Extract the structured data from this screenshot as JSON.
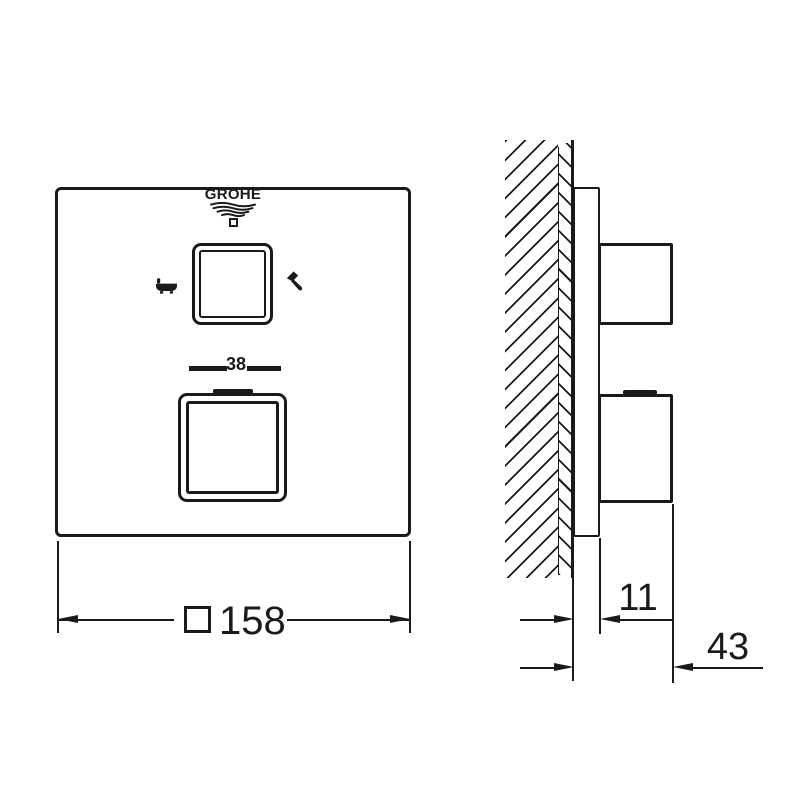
{
  "brand": {
    "name": "GROHE"
  },
  "front_view": {
    "temperature_mark": "38",
    "width_dimension": {
      "prefix_symbol": "square",
      "value": "158"
    }
  },
  "side_view": {
    "plate_depth": "11",
    "overall_depth": "43"
  },
  "icons": {
    "upper_knob_left": "bathtub-icon",
    "upper_knob_right": "handshower-icon",
    "under_brand": "grohe-waves-icon",
    "under_waves": "grohe-square-icon"
  },
  "style": {
    "line_color": "#1a1a1a",
    "background": "#ffffff"
  }
}
